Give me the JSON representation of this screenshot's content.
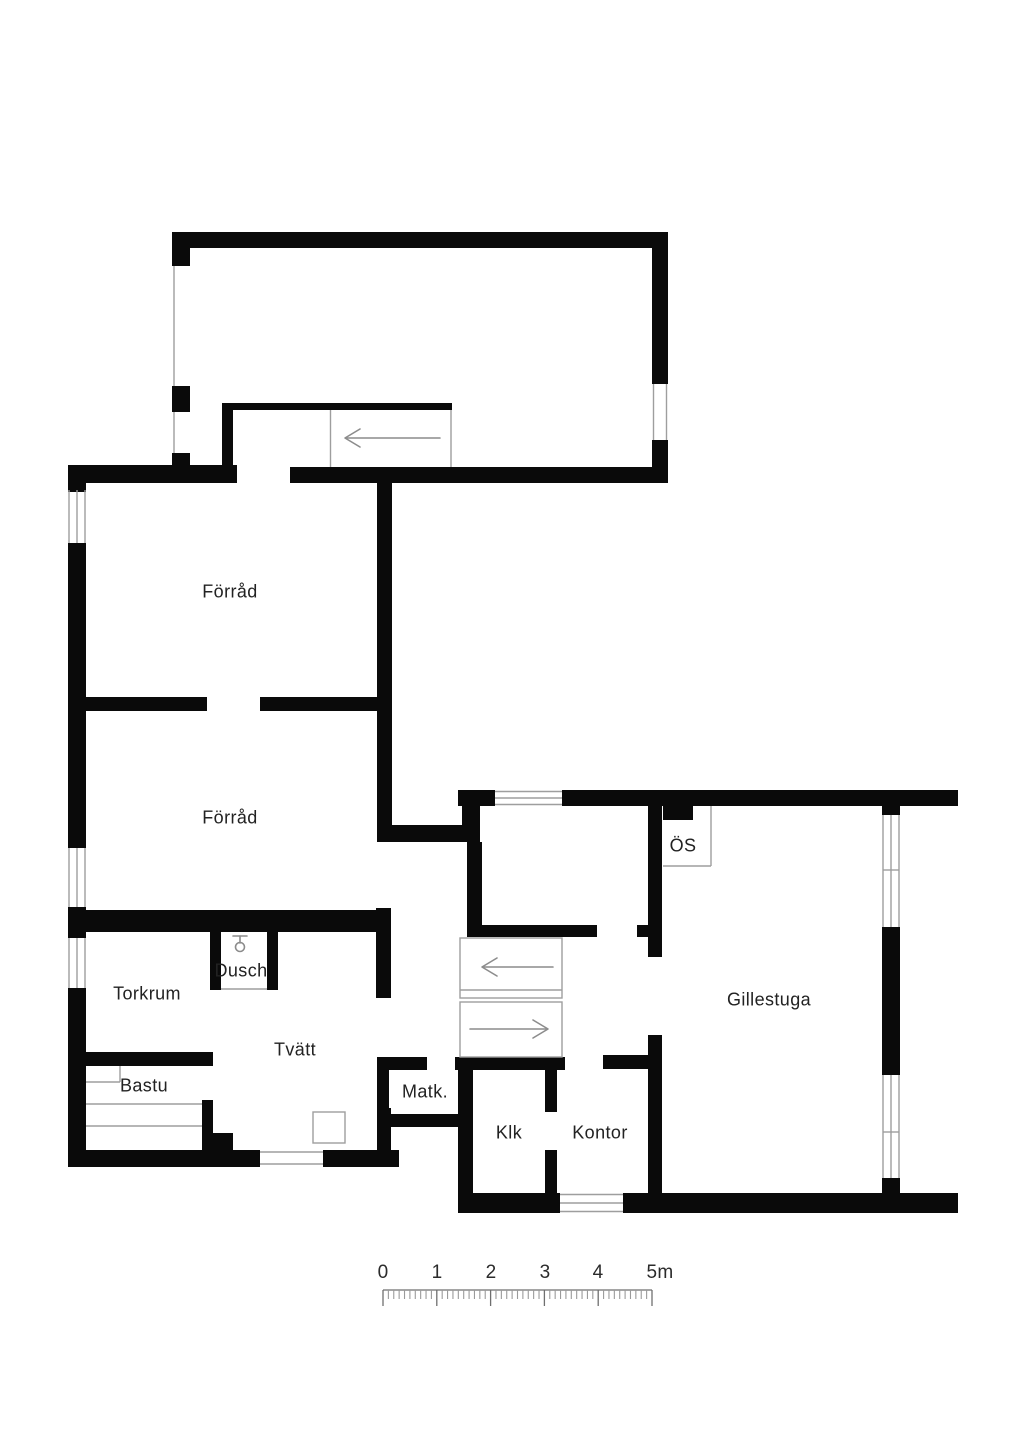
{
  "plan": {
    "title": "Basement floor plan",
    "rooms": {
      "forrad_upper": "Förråd",
      "forrad_lower": "Förråd",
      "torkrum": "Torkrum",
      "dusch": "Dusch",
      "tvatt": "Tvätt",
      "bastu": "Bastu",
      "matk": "Matk.",
      "klk": "Klk",
      "kontor": "Kontor",
      "gillestuga": "Gillestuga",
      "os": "ÖS"
    },
    "icons": {
      "shower": "shower-head-icon",
      "stair_up_arrow": "arrow-left",
      "stair_down_arrow": "arrow-right"
    }
  },
  "scale": {
    "labels": [
      "0",
      "1",
      "2",
      "3",
      "4",
      "5m"
    ],
    "unit": "m",
    "meters": 5,
    "minors_per_major": 10
  },
  "colors": {
    "wall": "#0a0a0a",
    "line": "#9e9e9e",
    "text": "#222222",
    "background": "#ffffff"
  }
}
